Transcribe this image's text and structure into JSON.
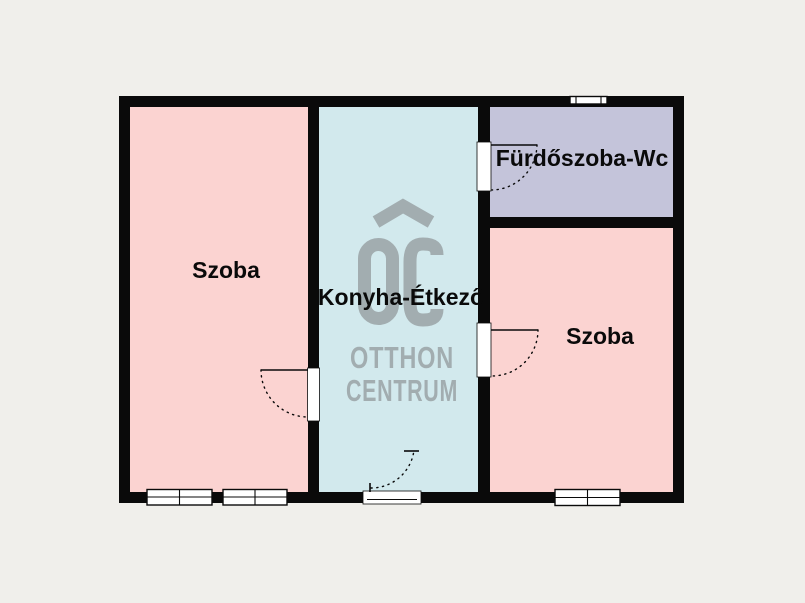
{
  "plan": {
    "rooms": [
      {
        "id": "room-left",
        "label": "Szoba"
      },
      {
        "id": "kitchen",
        "label": "Konyha-Étkező"
      },
      {
        "id": "bathroom",
        "label": "Fürdőszoba-Wc"
      },
      {
        "id": "room-right",
        "label": "Szoba"
      }
    ]
  },
  "watermark": {
    "monogram": "OC",
    "line1": "OTTHON",
    "line2": "CENTRUM"
  },
  "colors": {
    "bg": "#f0efeb",
    "wall": "#0a0a0a",
    "line": "#0a0a0a",
    "room-pink": "#fbd3d1",
    "room-cyan": "#d2e9ed",
    "room-lavender": "#c4c4da",
    "watermark": "#a2adb0"
  }
}
